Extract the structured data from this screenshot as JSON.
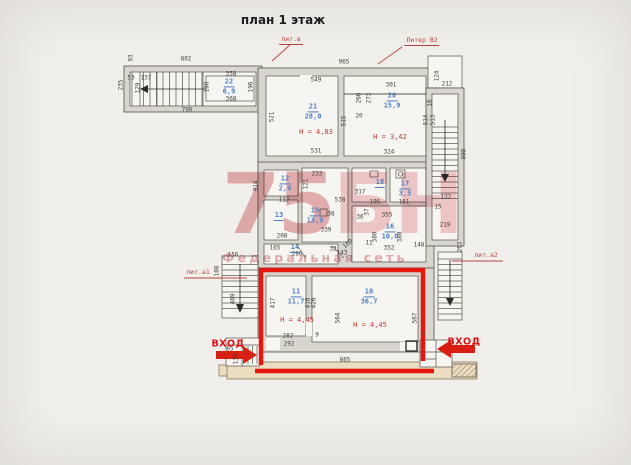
{
  "title": "план 1 этаж",
  "watermark": {
    "logo_left": "75",
    "logo_right": "БН",
    "tagline": "Федеральная сеть"
  },
  "annotations": {
    "liter_labels": [
      {
        "text": "лит.в",
        "x": 291,
        "y": 40,
        "underline": true
      },
      {
        "text": "Литер В2",
        "x": 422,
        "y": 41,
        "underline": true
      },
      {
        "text": "лит.а1",
        "x": 198,
        "y": 272,
        "underline": false
      },
      {
        "text": "лит.а2",
        "x": 486,
        "y": 255,
        "underline": false
      }
    ],
    "entrances": [
      {
        "label": "ВХОД",
        "side": "left",
        "x": 228,
        "y": 344
      },
      {
        "label": "ВХОД",
        "side": "right",
        "x": 464,
        "y": 342
      }
    ]
  },
  "rooms": [
    {
      "number": "22",
      "area": "6,9",
      "x": 229,
      "y": 87
    },
    {
      "number": "21",
      "area": "28,0",
      "x": 313,
      "y": 112
    },
    {
      "number": "20",
      "area": "15,9",
      "x": 392,
      "y": 101
    },
    {
      "number": "12",
      "area": "2,4",
      "x": 285,
      "y": 184
    },
    {
      "number": "13",
      "area": "",
      "x": 279,
      "y": 216
    },
    {
      "number": "15",
      "area": "13,9",
      "x": 315,
      "y": 216
    },
    {
      "number": "14",
      "area": "",
      "x": 295,
      "y": 248
    },
    {
      "number": "18",
      "area": "",
      "x": 380,
      "y": 183
    },
    {
      "number": "17",
      "area": "3,5",
      "x": 405,
      "y": 189
    },
    {
      "number": "16",
      "area": "10,0",
      "x": 390,
      "y": 232
    },
    {
      "number": "11",
      "area": "11,7",
      "x": 296,
      "y": 297
    },
    {
      "number": "10",
      "area": "36,7",
      "x": 369,
      "y": 297
    }
  ],
  "height_labels": [
    {
      "text": "Н = 4,83",
      "x": 316,
      "y": 132
    },
    {
      "text": "Н = 3,42",
      "x": 390,
      "y": 137
    },
    {
      "text": "Н = 4,45",
      "x": 297,
      "y": 320
    },
    {
      "text": "Н = 4,45",
      "x": 370,
      "y": 325
    }
  ],
  "dimensions": [
    {
      "t": "802",
      "x": 186,
      "y": 59
    },
    {
      "t": "93",
      "x": 131,
      "y": 58,
      "r": -90
    },
    {
      "t": "965",
      "x": 344,
      "y": 62
    },
    {
      "t": "235",
      "x": 121,
      "y": 85,
      "r": -90
    },
    {
      "t": "53",
      "x": 131,
      "y": 78
    },
    {
      "t": "137",
      "x": 146,
      "y": 78
    },
    {
      "t": "129",
      "x": 138,
      "y": 88,
      "r": -90
    },
    {
      "t": "790",
      "x": 187,
      "y": 110
    },
    {
      "t": "358",
      "x": 231,
      "y": 74
    },
    {
      "t": "368",
      "x": 231,
      "y": 99
    },
    {
      "t": "100",
      "x": 207,
      "y": 87,
      "r": -90
    },
    {
      "t": "196",
      "x": 251,
      "y": 87,
      "r": -90
    },
    {
      "t": "549",
      "x": 316,
      "y": 80
    },
    {
      "t": "301",
      "x": 391,
      "y": 85
    },
    {
      "t": "266",
      "x": 359,
      "y": 98,
      "r": -90
    },
    {
      "t": "273",
      "x": 369,
      "y": 98,
      "r": -90
    },
    {
      "t": "521",
      "x": 272,
      "y": 117,
      "r": -90
    },
    {
      "t": "515",
      "x": 344,
      "y": 121,
      "r": -90
    },
    {
      "t": "20",
      "x": 359,
      "y": 116
    },
    {
      "t": "514",
      "x": 426,
      "y": 120,
      "r": -90
    },
    {
      "t": "513",
      "x": 433,
      "y": 120,
      "r": -90
    },
    {
      "t": "531",
      "x": 316,
      "y": 151
    },
    {
      "t": "324",
      "x": 389,
      "y": 152
    },
    {
      "t": "16",
      "x": 430,
      "y": 103,
      "r": -90
    },
    {
      "t": "124",
      "x": 437,
      "y": 76,
      "r": -90
    },
    {
      "t": "212",
      "x": 447,
      "y": 84
    },
    {
      "t": "808",
      "x": 464,
      "y": 154,
      "r": -90
    },
    {
      "t": "914",
      "x": 256,
      "y": 186,
      "r": -90
    },
    {
      "t": "233",
      "x": 317,
      "y": 174
    },
    {
      "t": "121",
      "x": 306,
      "y": 184,
      "r": -90
    },
    {
      "t": "112",
      "x": 284,
      "y": 200
    },
    {
      "t": "538",
      "x": 340,
      "y": 200
    },
    {
      "t": "317",
      "x": 360,
      "y": 192
    },
    {
      "t": "195",
      "x": 375,
      "y": 202
    },
    {
      "t": "161",
      "x": 404,
      "y": 202
    },
    {
      "t": "355",
      "x": 387,
      "y": 215
    },
    {
      "t": "37",
      "x": 367,
      "y": 212,
      "r": -90
    },
    {
      "t": "36",
      "x": 360,
      "y": 217
    },
    {
      "t": "38",
      "x": 331,
      "y": 214
    },
    {
      "t": "339",
      "x": 326,
      "y": 230
    },
    {
      "t": "380",
      "x": 375,
      "y": 237,
      "r": -90
    },
    {
      "t": "380",
      "x": 400,
      "y": 237,
      "r": -90
    },
    {
      "t": "352",
      "x": 389,
      "y": 248
    },
    {
      "t": "11",
      "x": 369,
      "y": 243
    },
    {
      "t": "208",
      "x": 282,
      "y": 236
    },
    {
      "t": "165",
      "x": 275,
      "y": 248
    },
    {
      "t": "280",
      "x": 297,
      "y": 254
    },
    {
      "t": "33",
      "x": 333,
      "y": 249
    },
    {
      "t": "143",
      "x": 342,
      "y": 253
    },
    {
      "t": "168",
      "x": 348,
      "y": 244,
      "r": -40
    },
    {
      "t": "263",
      "x": 460,
      "y": 247,
      "r": -90
    },
    {
      "t": "148",
      "x": 419,
      "y": 245
    },
    {
      "t": "156",
      "x": 233,
      "y": 255
    },
    {
      "t": "108",
      "x": 217,
      "y": 271,
      "r": -90
    },
    {
      "t": "469",
      "x": 233,
      "y": 299,
      "r": -90
    },
    {
      "t": "122",
      "x": 446,
      "y": 197
    },
    {
      "t": "15",
      "x": 438,
      "y": 207
    },
    {
      "t": "219",
      "x": 445,
      "y": 225
    },
    {
      "t": "417",
      "x": 273,
      "y": 303,
      "r": -90
    },
    {
      "t": "416",
      "x": 308,
      "y": 303,
      "r": -90
    },
    {
      "t": "426",
      "x": 314,
      "y": 303,
      "r": -90
    },
    {
      "t": "564",
      "x": 338,
      "y": 318,
      "r": -90
    },
    {
      "t": "567",
      "x": 415,
      "y": 318,
      "r": -90
    },
    {
      "t": "282",
      "x": 288,
      "y": 336
    },
    {
      "t": "292",
      "x": 289,
      "y": 344
    },
    {
      "t": "9",
      "x": 317,
      "y": 335
    },
    {
      "t": "865",
      "x": 345,
      "y": 360
    },
    {
      "t": "65",
      "x": 230,
      "y": 349
    },
    {
      "t": "139",
      "x": 236,
      "y": 359,
      "r": -90
    },
    {
      "t": "7",
      "x": 424,
      "y": 335
    }
  ]
}
